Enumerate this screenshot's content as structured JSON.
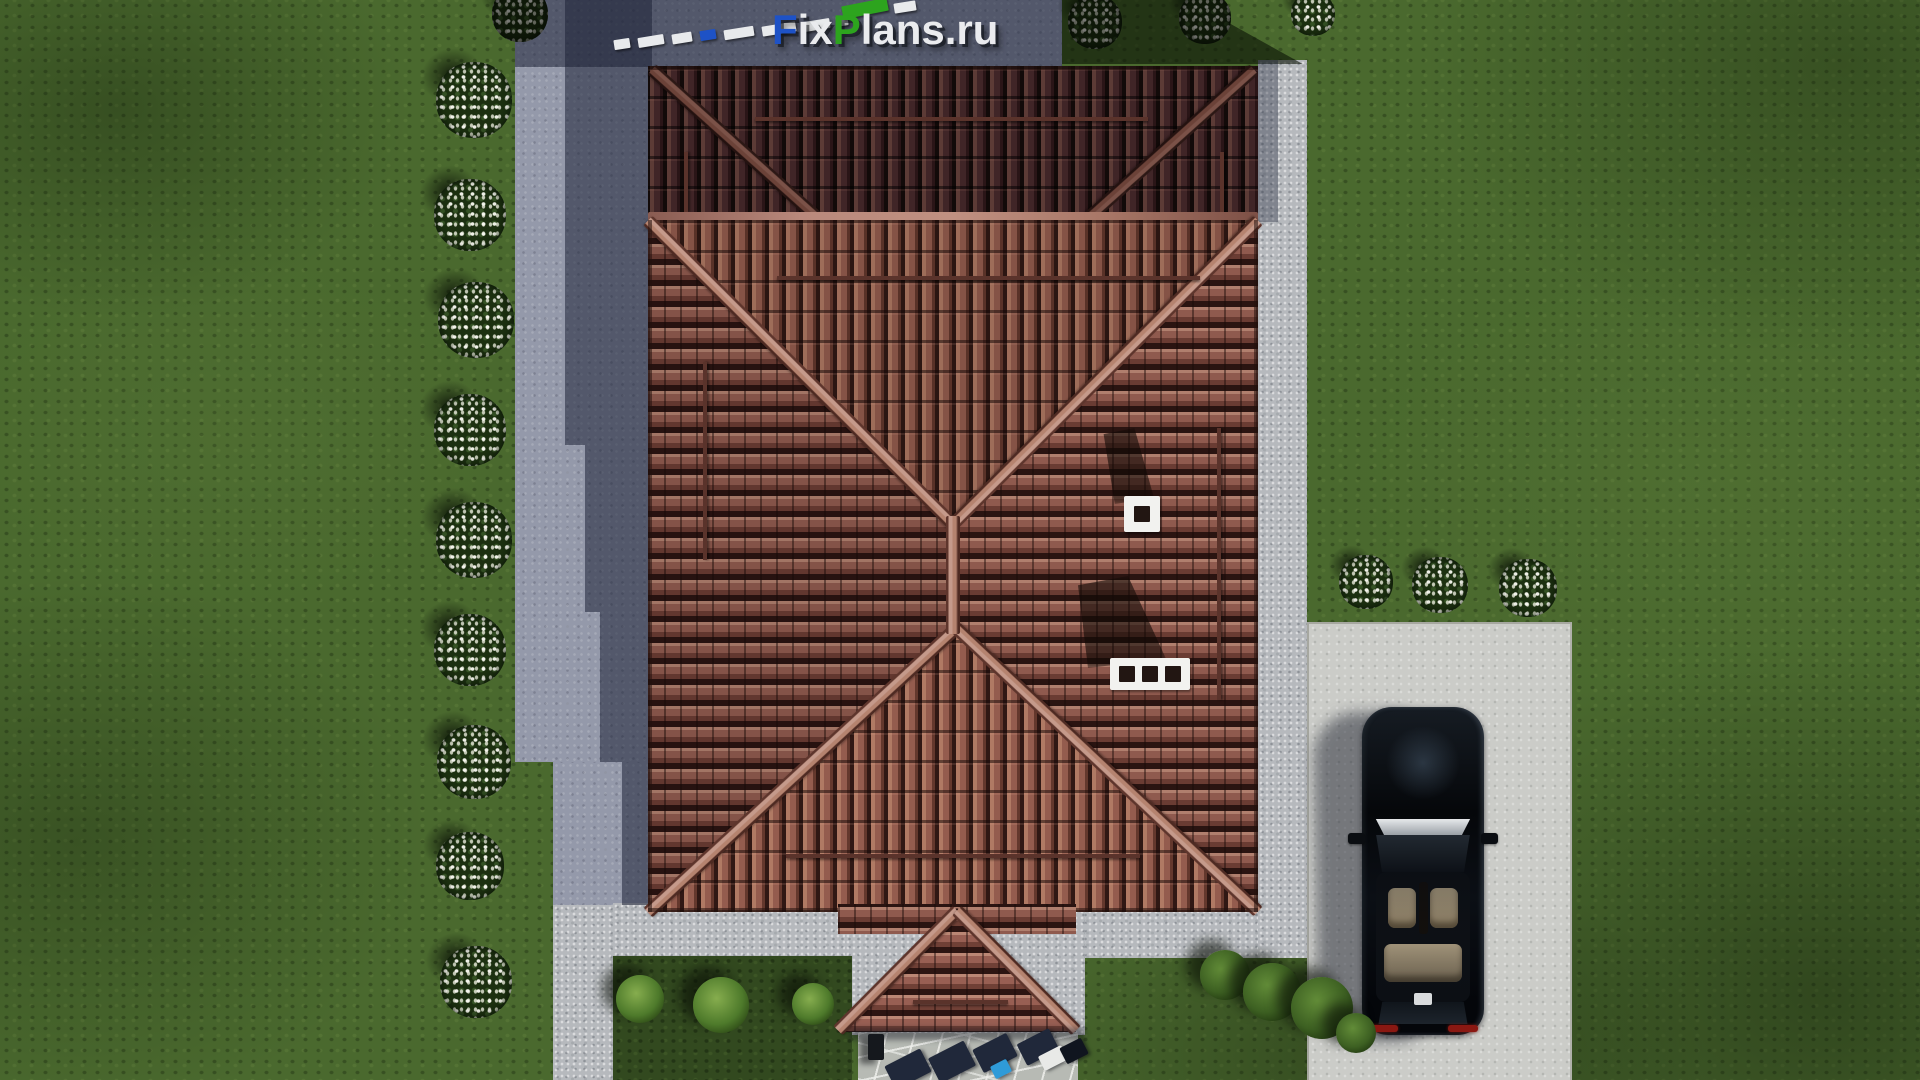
{
  "watermark": {
    "full_text": "FixPlans.ru",
    "part_f": "F",
    "part_ix": "ix",
    "part_p": "P",
    "part_rest": "lans.ru"
  },
  "colors": {
    "logo_blue": "#1e52c6",
    "logo_green": "#2da41e",
    "logo_white": "#eaebee",
    "grass": "#4a692e",
    "grass_dark_patch": "#32491f",
    "pavement_concrete": "#9499aa",
    "pavement_pebble": "#b6b9bd",
    "driveway": "#cbccc8",
    "stone_path": "#b7bab4",
    "shadow_pavement": "rgba(30,35,54,0.55)",
    "shadow_grass": "rgba(12,19,7,0.62)",
    "roof_tile_light": "#8f5a4e",
    "roof_tile_dark": "#402527",
    "roof_ridge": "#bb8a7c",
    "chimney": "#f2f2ef",
    "car_body": "#07090d",
    "car_seats": "#bfae8f"
  }
}
